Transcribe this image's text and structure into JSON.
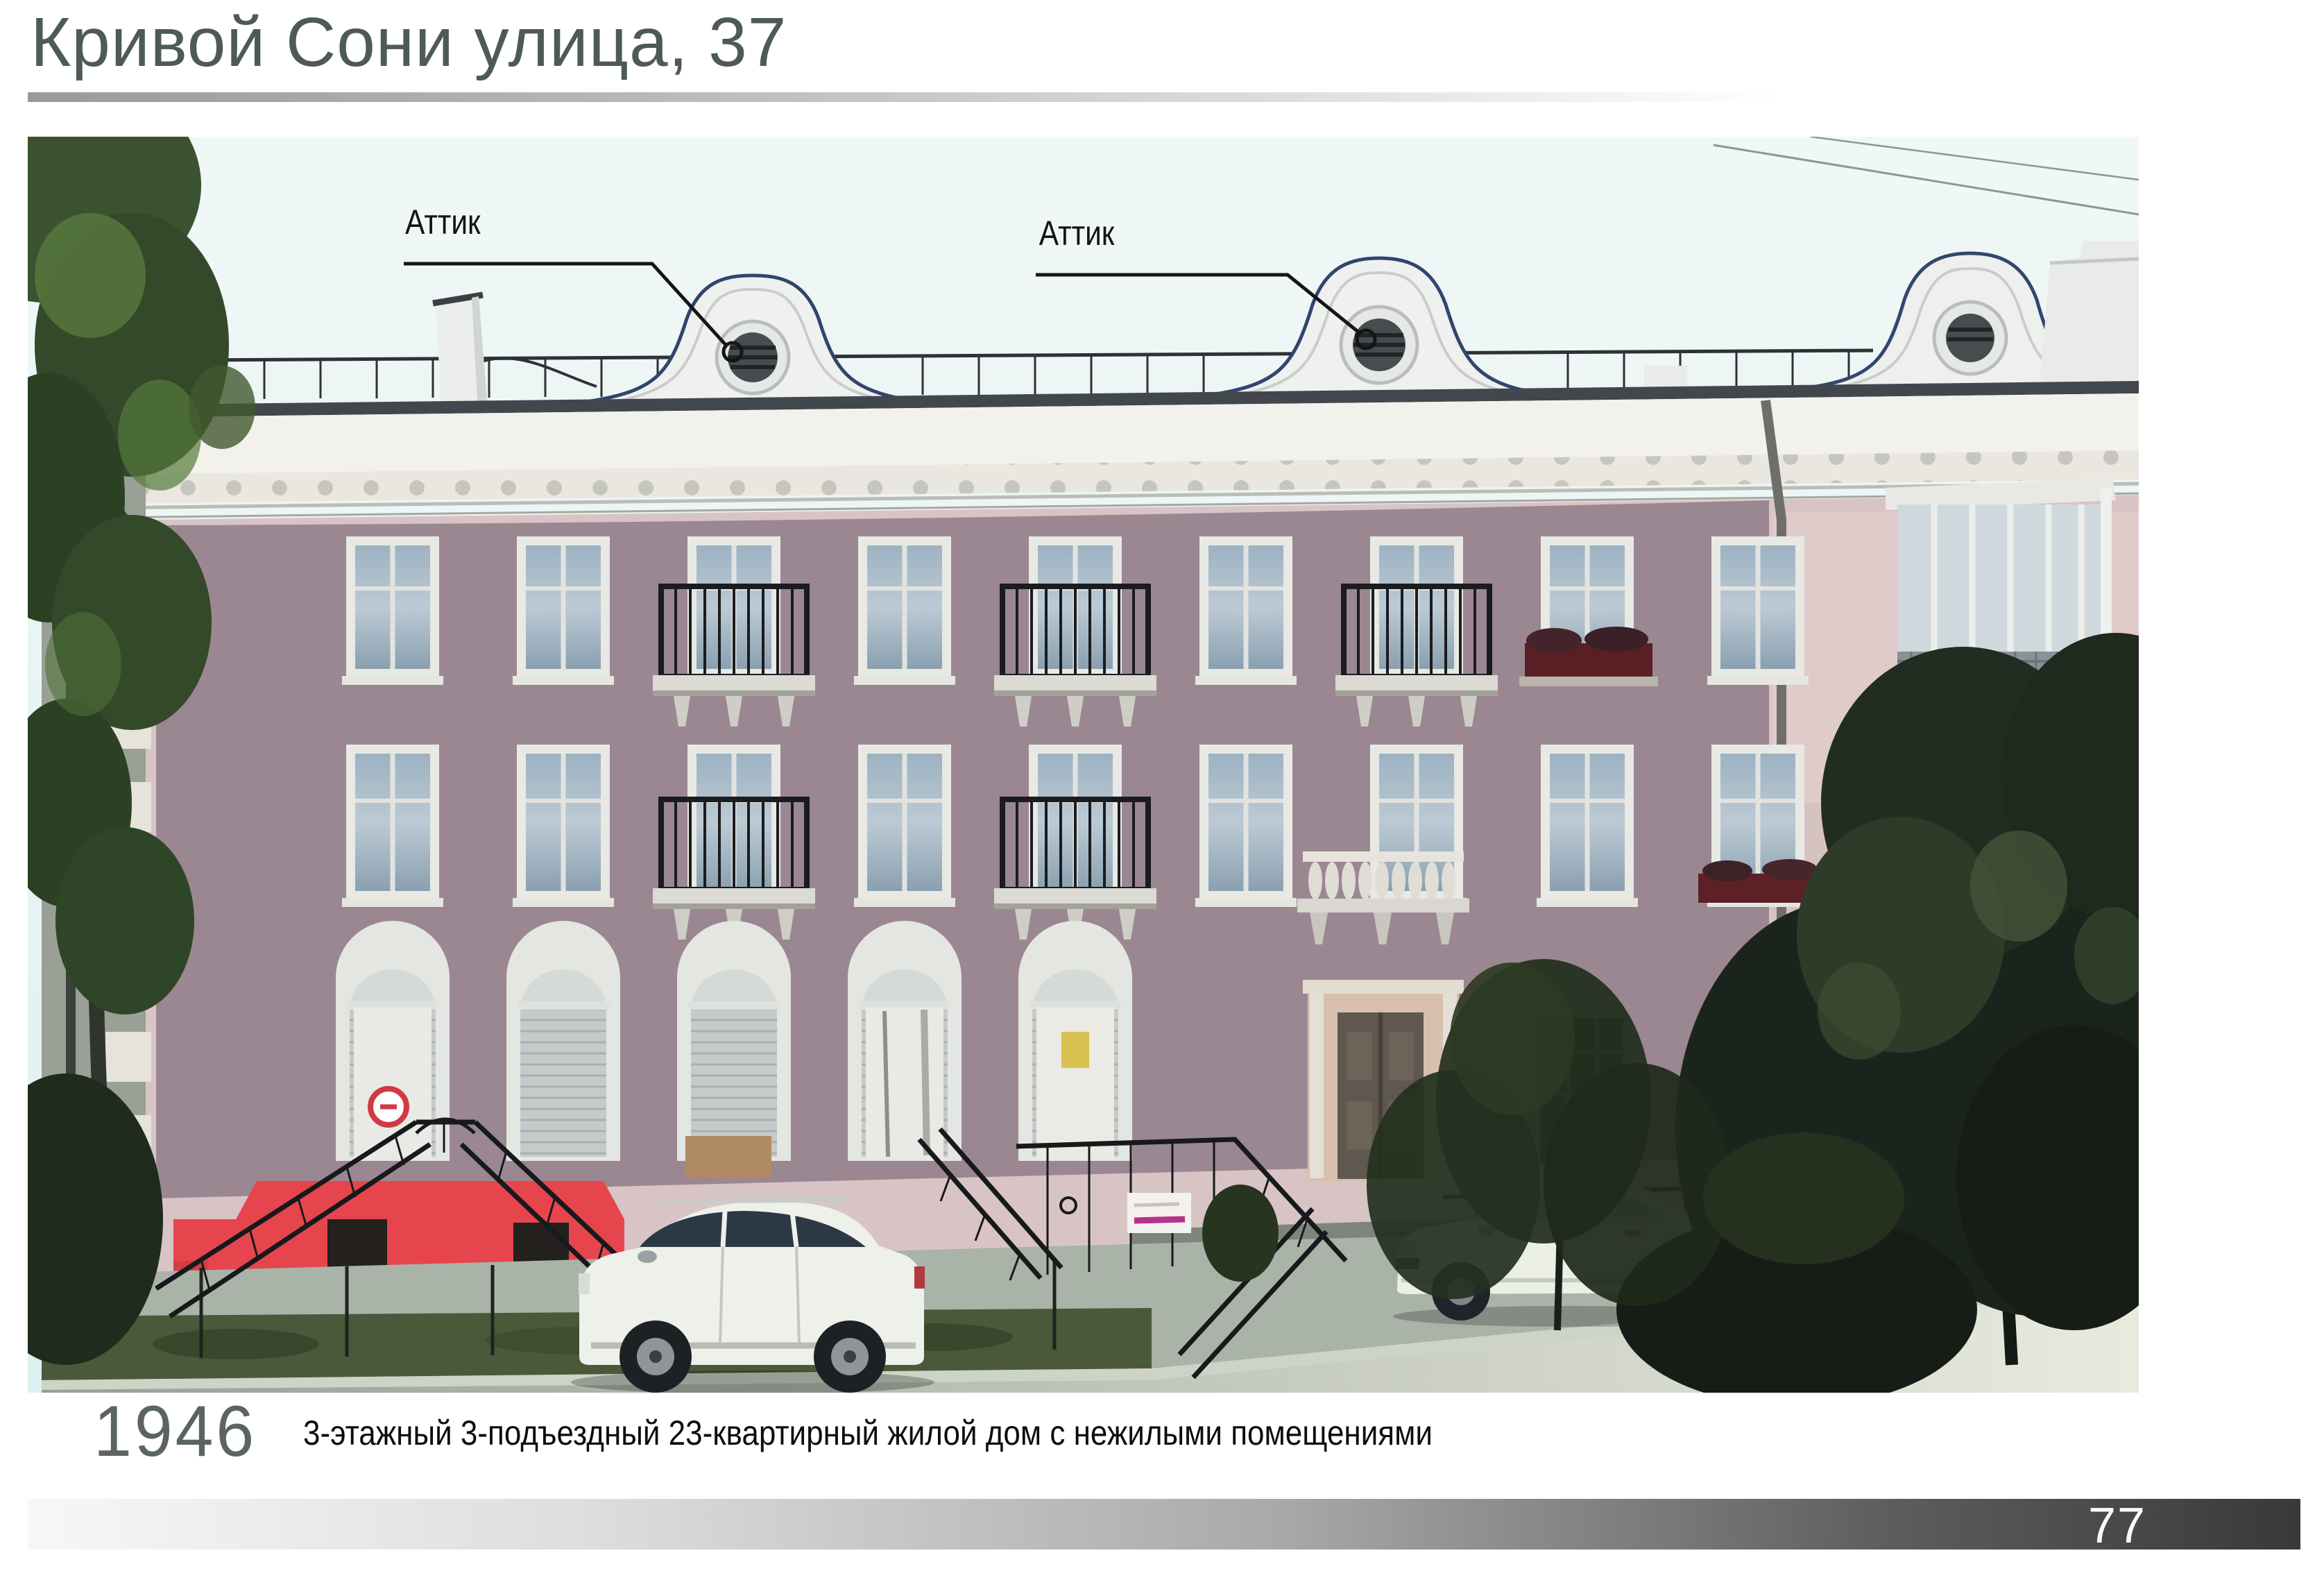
{
  "page": {
    "title": "Кривой Сони улица, 37",
    "page_number": "77"
  },
  "annotations": [
    {
      "label": "Аттик"
    },
    {
      "label": "Аттик"
    }
  ],
  "caption": {
    "year": "1946",
    "text": "3-этажный 3-подъездный 23-квартирный жилой дом с нежилыми помещениями"
  },
  "colors": {
    "title_text": "#4e5a58",
    "caption_year": "#5b6462",
    "caption_text": "#0d0d0d",
    "page_number_text": "#fafafa",
    "top_rule_gradient_start": "#9a9a9a",
    "bottom_bar_gradient_end": "#393939",
    "facade_overlay_mauve": "#9b8791",
    "facade_original_pink": "#d9c4c5",
    "basement_red": "#e6454d",
    "sky": "#e9f5f3",
    "cornice_white": "#f2f1eb"
  }
}
